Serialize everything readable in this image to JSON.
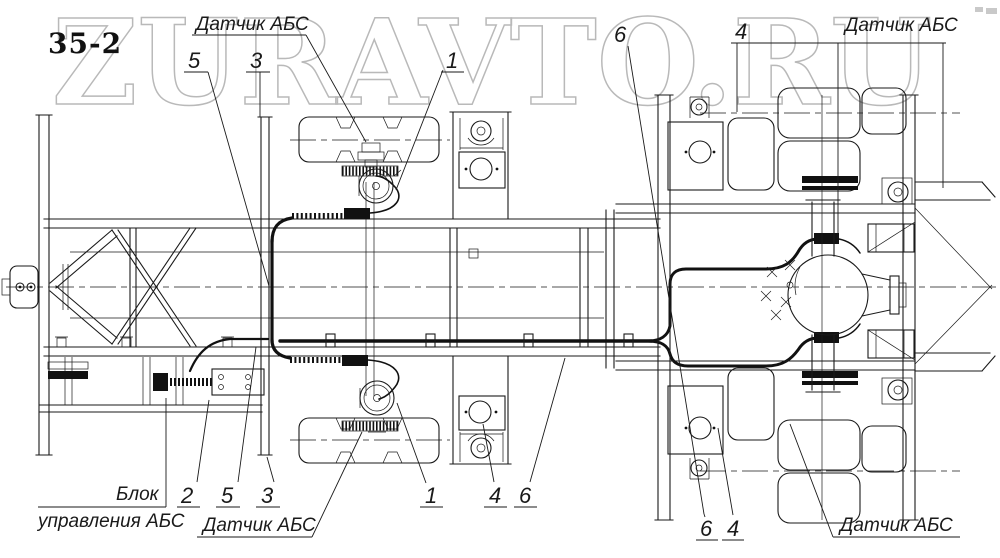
{
  "title": "35-2",
  "watermark": {
    "text": "ZURAVTO.RU",
    "color": "#b9b9b9"
  },
  "colors": {
    "line": "#1a1a1a",
    "background": "#ffffff"
  },
  "labels": {
    "sensor_top_left": "Датчик АБС",
    "sensor_top_right": "Датчик АБС",
    "sensor_bottom_center": "Датчик АБС",
    "sensor_bottom_right": "Датчик АБС",
    "control_block_line1": "Блок",
    "control_block_line2": "управления АБС"
  },
  "callouts": {
    "top_5": "5",
    "top_3": "3",
    "top_1": "1",
    "top_6": "6",
    "top_4": "4",
    "bottom_2": "2",
    "bottom_5": "5",
    "bottom_3": "3",
    "bottom_1": "1",
    "bottom_4": "4",
    "bottom_6": "6",
    "bottom_right_6": "6",
    "bottom_right_4": "4"
  }
}
